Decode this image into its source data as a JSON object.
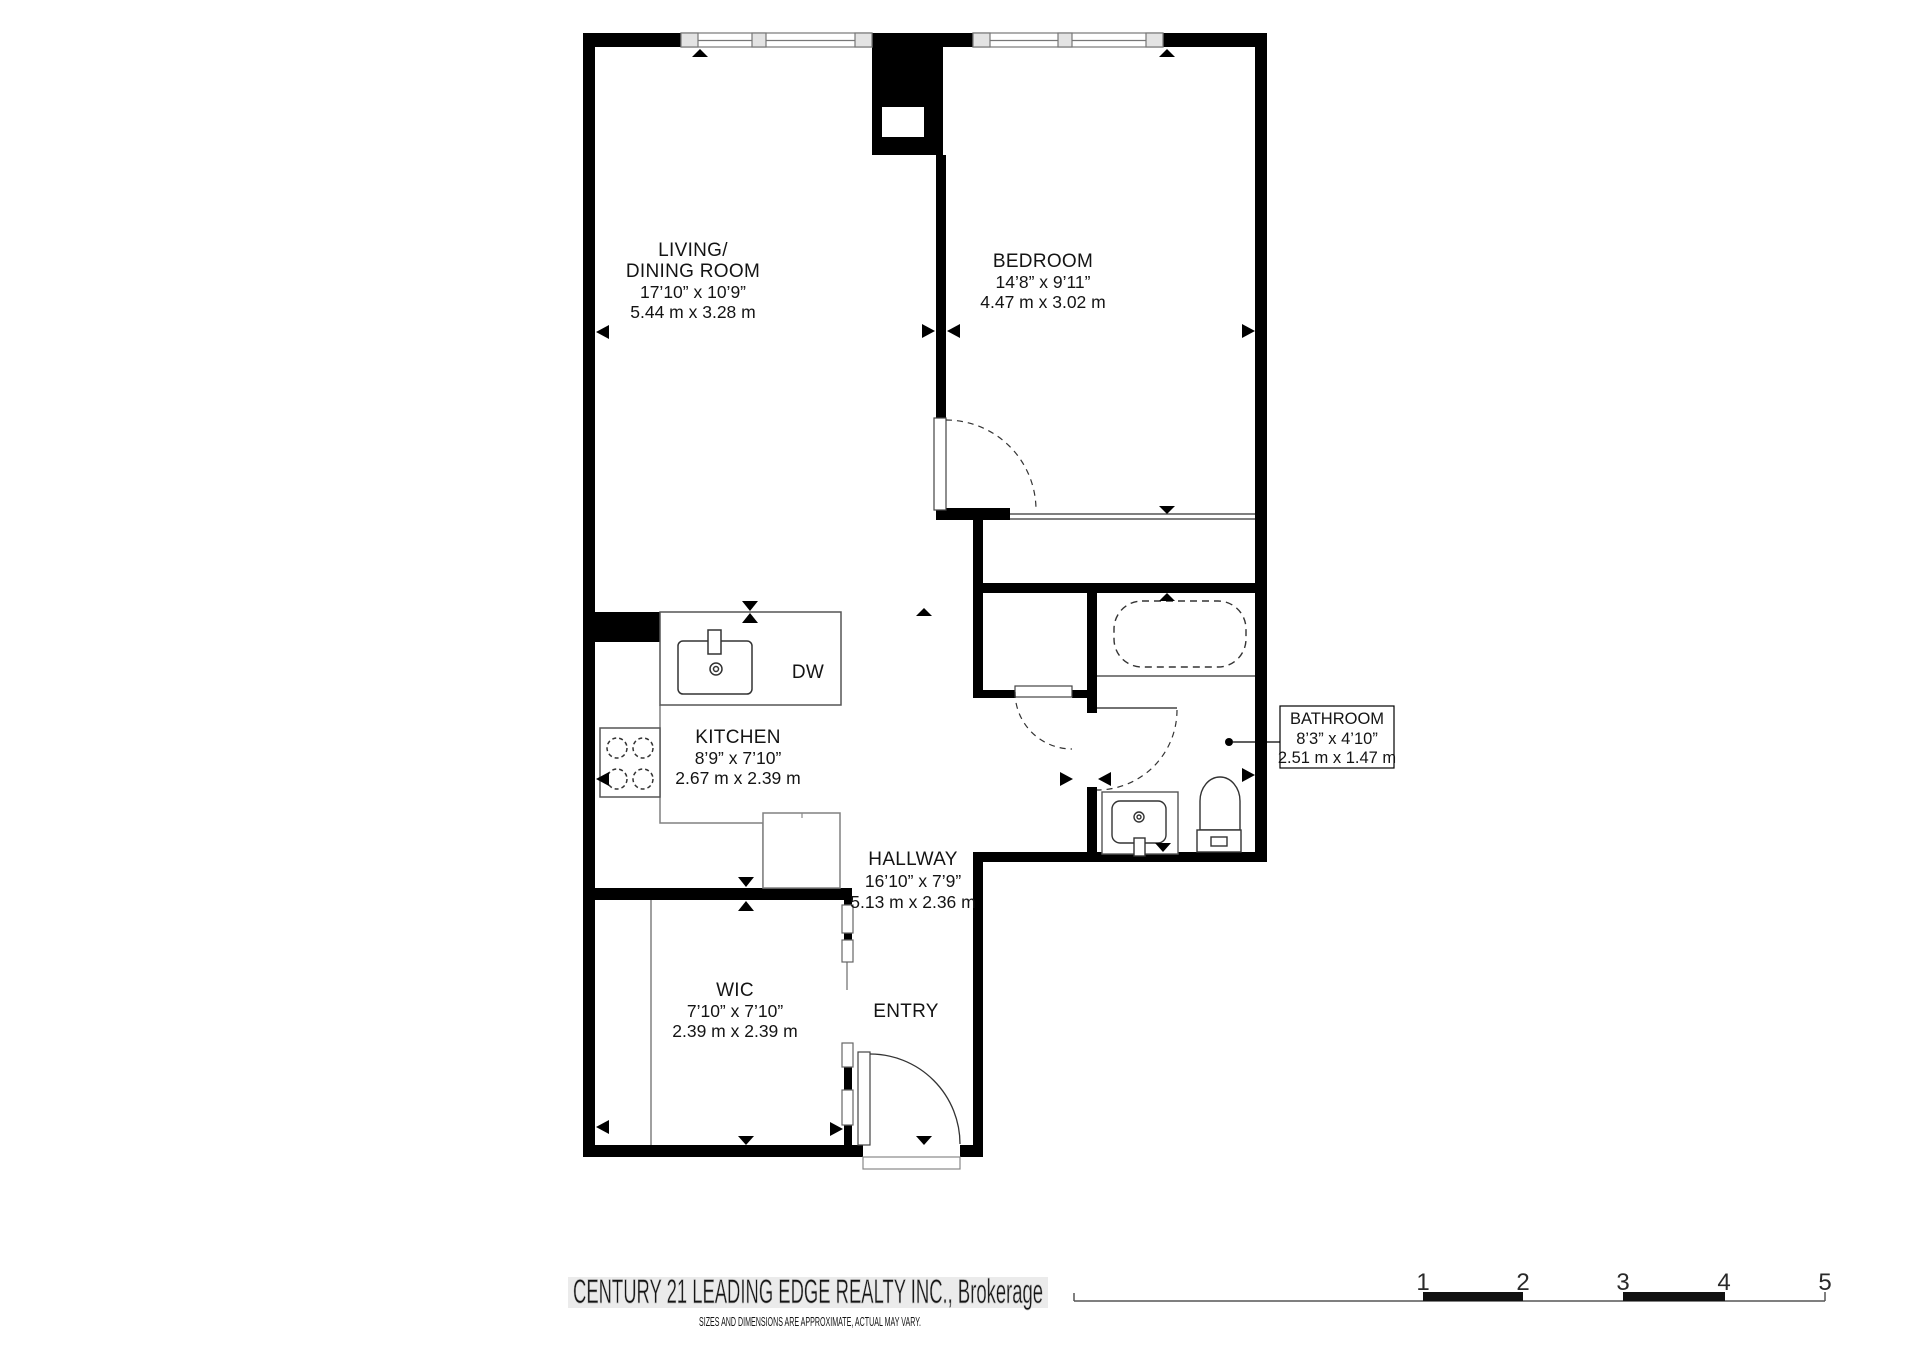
{
  "plan": {
    "rooms": {
      "living": {
        "name_line1": "LIVING/",
        "name_line2": "DINING ROOM",
        "dim_imperial": "17’10” x 10’9”",
        "dim_metric": "5.44 m x 3.28 m"
      },
      "bedroom": {
        "name": "BEDROOM",
        "dim_imperial": "14’8” x 9’11”",
        "dim_metric": "4.47 m x 3.02 m"
      },
      "kitchen": {
        "name": "KITCHEN",
        "dim_imperial": "8’9” x 7’10”",
        "dim_metric": "2.67 m x 2.39 m"
      },
      "hallway": {
        "name": "HALLWAY",
        "dim_imperial": "16’10” x 7’9”",
        "dim_metric": "5.13 m x 2.36 m"
      },
      "wic": {
        "name": "WIC",
        "dim_imperial": "7’10” x 7’10”",
        "dim_metric": "2.39 m x 2.39 m"
      },
      "entry": {
        "name": "ENTRY"
      },
      "bathroom": {
        "name": "BATHROOM",
        "dim_imperial": "8’3” x 4’10”",
        "dim_metric": "2.51 m x 1.47 m"
      }
    },
    "labels": {
      "dishwasher": "DW"
    }
  },
  "scale_bar": {
    "ticks": [
      "1",
      "2",
      "3",
      "4",
      "5"
    ]
  },
  "footer": {
    "brand": "CENTURY 21 LEADING EDGE REALTY INC., Brokerage",
    "disclaimer": "SIZES AND DIMENSIONS ARE APPROXIMATE, ACTUAL MAY VARY."
  },
  "colors": {
    "wall": "#000000",
    "thin_line": "#808080",
    "fixture": "#333333",
    "footer_band": "#ebebeb",
    "footer_text": "#f6f6f6"
  }
}
